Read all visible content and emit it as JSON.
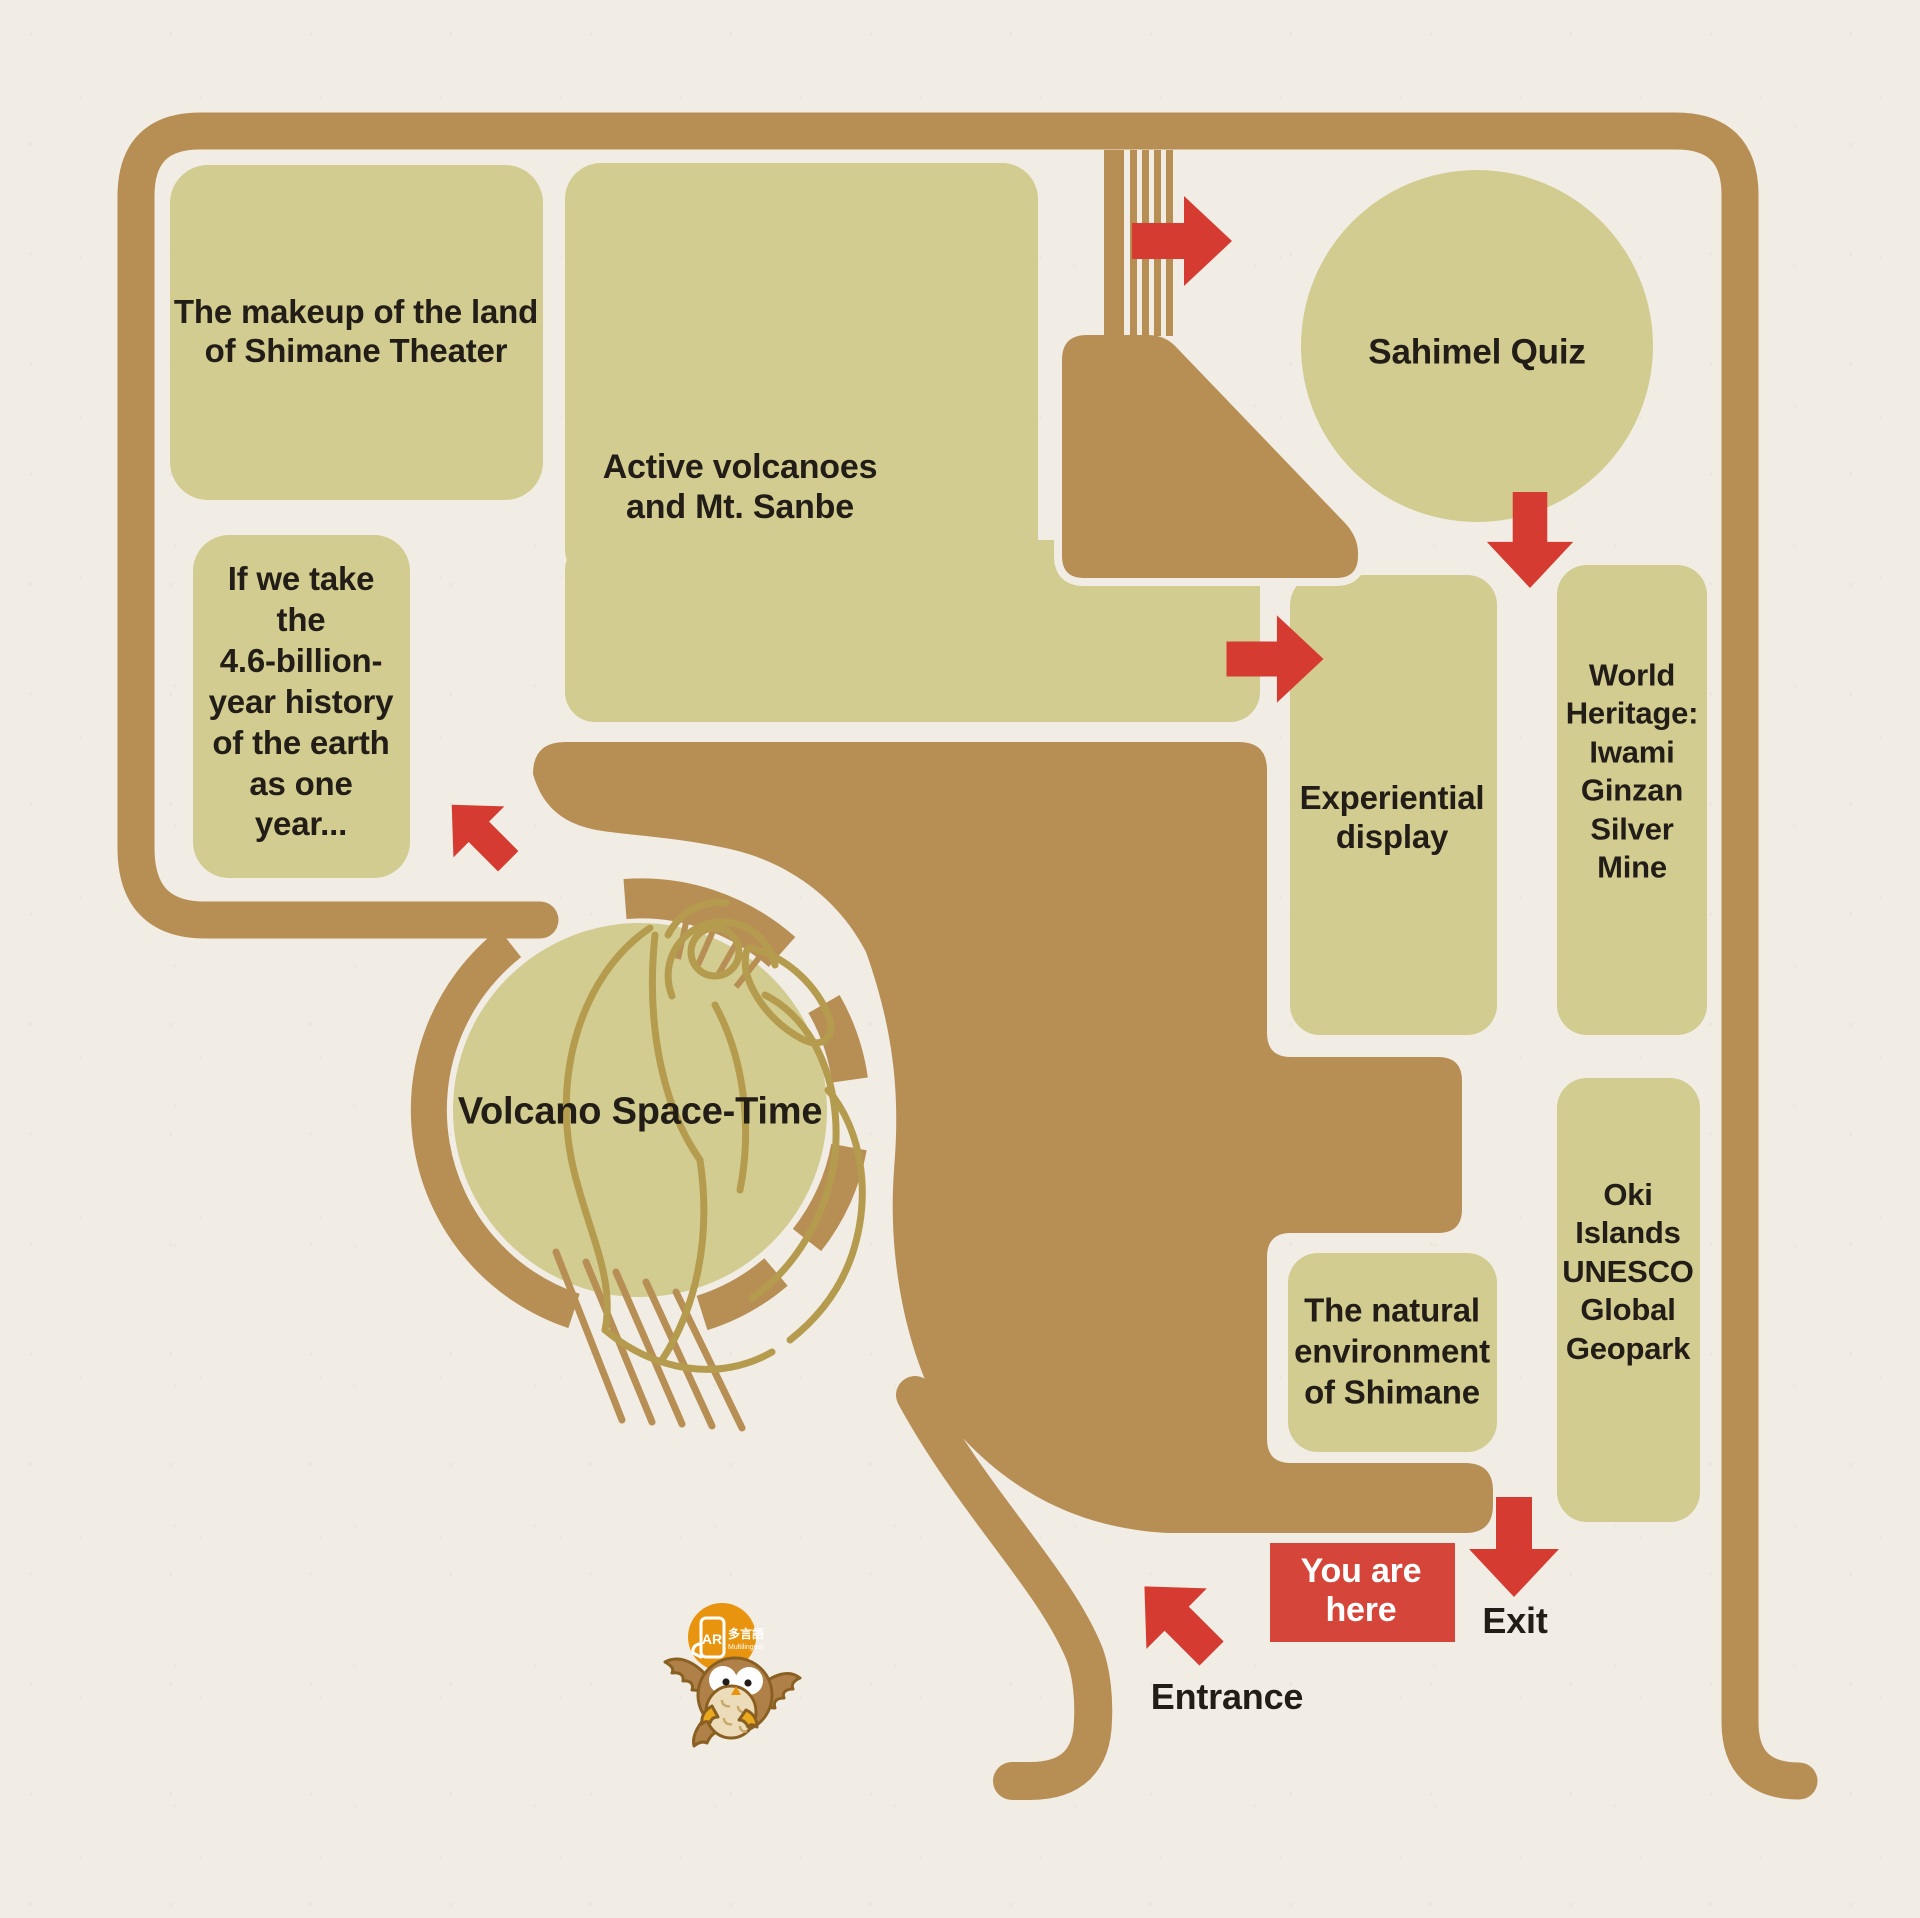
{
  "map": {
    "areas": {
      "theater": "The makeup of the land\nof Shimane Theater",
      "active_volcanoes": "Active volcanoes\nand Mt. Sanbe",
      "sahimel_quiz": "Sahimel Quiz",
      "history_one_year": "If we take\nthe\n4.6-billion-\nyear history\nof the earth\nas one\nyear...",
      "experiential_display": "Experiential\ndisplay",
      "world_heritage": "World\nHeritage:\nIwami\nGinzan\nSilver\nMine",
      "volcano_space_time": "Volcano Space-Time",
      "natural_environment": "The natural\nenvironment\nof Shimane",
      "oki_geopark": "Oki\nIslands\nUNESCO\nGlobal\nGeopark"
    },
    "markers": {
      "you_are_here": "You are\nhere",
      "exit": "Exit",
      "entrance": "Entrance"
    },
    "mascot_badge": {
      "ar": "AR",
      "multilingual_jp": "多言語",
      "multilingual_en": "Multilingual"
    },
    "colors": {
      "paper": "#f1ede4",
      "area_green": "#d2cc90",
      "wall_brown": "#b78f55",
      "sketch_olive": "#b59b4e",
      "route_red": "#d63b31",
      "marker_red": "#d6453a",
      "text_black": "#221d17",
      "badge_orange": "#e8940e"
    }
  }
}
